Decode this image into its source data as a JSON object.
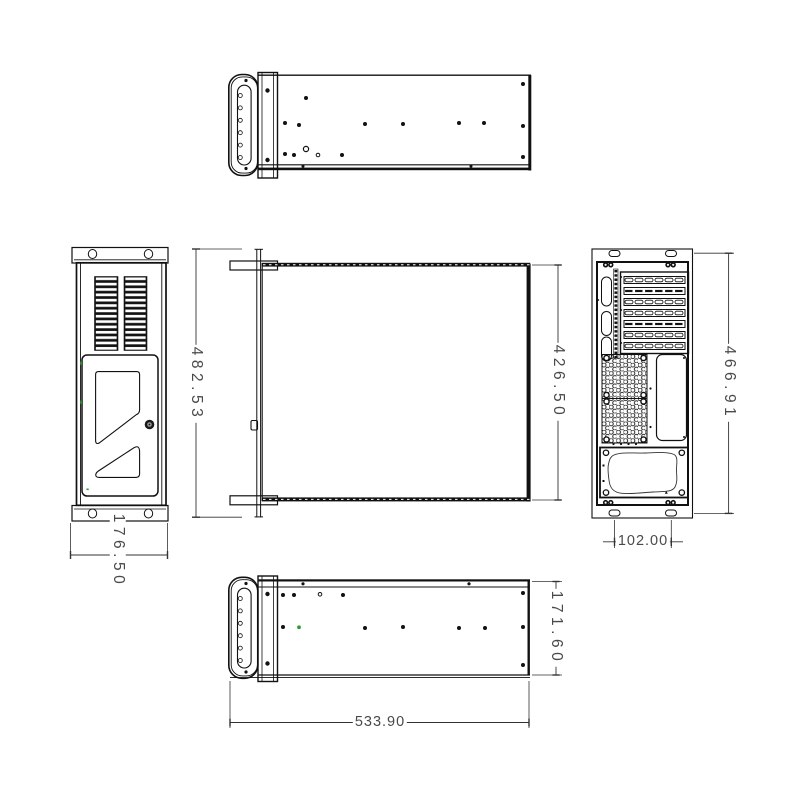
{
  "sheet": {
    "background": "#ffffff",
    "line_color": "#111111",
    "dim_text_color": "#4a4a4a",
    "accent_green": "#2f9e2f",
    "dimensions": {
      "plan_overall": "482.53",
      "plan_body": "426.50",
      "front_width": "176.50",
      "rear_height": "466.91",
      "rear_holes": "102.00",
      "side_height": "171.60",
      "side_length": "533.90"
    }
  }
}
